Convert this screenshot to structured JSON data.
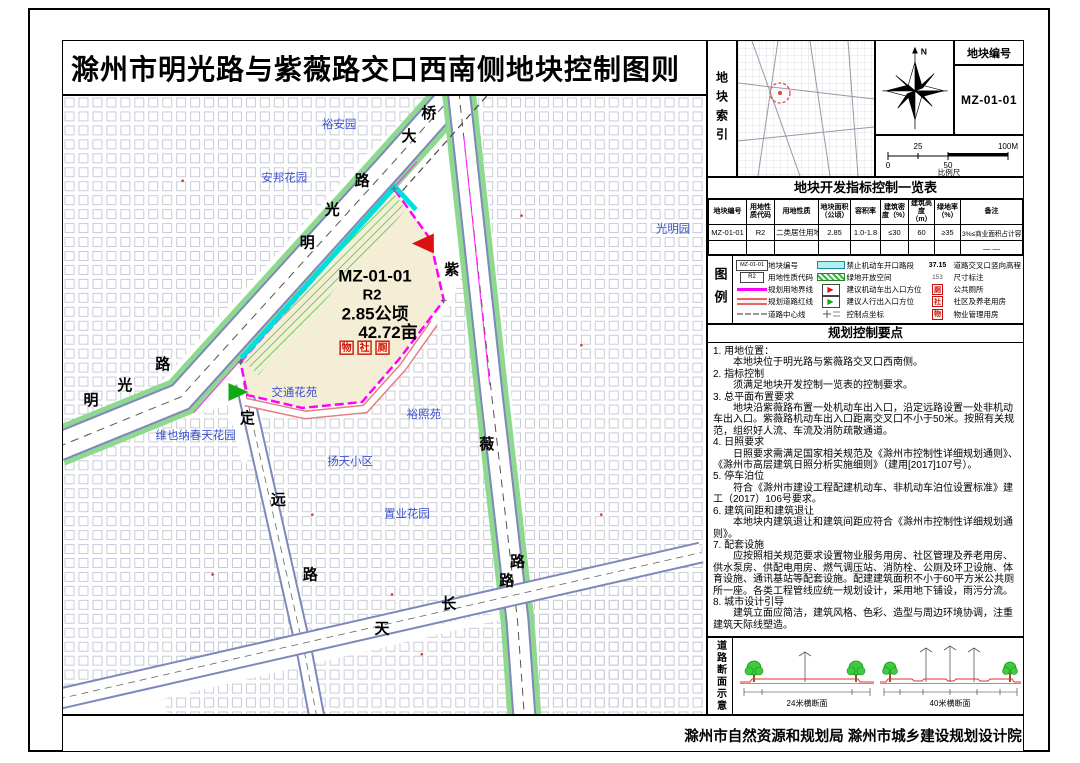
{
  "title": "滁州市明光路与紫薇路交口西南侧地块控制图则",
  "panel": {
    "index_label": "地块索引",
    "parcel_no_label": "地块编号",
    "parcel_no": "MZ-01-01",
    "north_label": "N",
    "scale": {
      "t25": "25",
      "t100": "100M",
      "t0": "0",
      "t50": "50",
      "caption": "比例尺"
    }
  },
  "table": {
    "title": "地块开发指标控制一览表",
    "headers": [
      "地块编号",
      "用地性质代码",
      "用地性质",
      "地块面积（公顷）",
      "容积率",
      "建筑密度（%）",
      "建筑高度（m）",
      "绿地率（%）",
      "备注"
    ],
    "rows": [
      [
        "MZ-01-01",
        "R2",
        "二类居住用地",
        "2.85",
        "1.0-1.8",
        "≤30",
        "60",
        "≥35",
        "3%≤商业面积占计容面积≤10%"
      ],
      [
        "",
        "",
        "",
        "",
        "",
        "",
        "",
        "",
        "— —"
      ]
    ]
  },
  "legend": {
    "label": "图例",
    "swatch1_text": "MZ-01-01",
    "swatch2_text": "R2",
    "col1": [
      {
        "label": "地块编号"
      },
      {
        "label": "用地性质代码"
      },
      {
        "label": "规划用地界线"
      },
      {
        "label": "规划道路红线"
      },
      {
        "label": "道路中心线"
      }
    ],
    "col2": [
      {
        "label": "禁止机动车开口路段"
      },
      {
        "label": "绿地开放空间"
      },
      {
        "label": "建议机动车出入口方位"
      },
      {
        "label": "建议人行出入口方位"
      },
      {
        "label": "控制点坐标"
      }
    ],
    "col3": [
      {
        "value": "37.15",
        "label": "道路交叉口竖向高程"
      },
      {
        "value": "153",
        "label": "尺寸标注"
      },
      {
        "value": "厕",
        "label": "公共厕所"
      },
      {
        "value": "社",
        "label": "社区及养老用房"
      },
      {
        "value": "物",
        "label": "物业管理用房"
      }
    ]
  },
  "notes": {
    "title": "规划控制要点",
    "items": [
      {
        "h": "1. 用地位置：",
        "b": "本地块位于明光路与紫薇路交叉口西南侧。"
      },
      {
        "h": "2. 指标控制",
        "b": "须满足地块开发控制一览表的控制要求。"
      },
      {
        "h": "3. 总平面布置要求",
        "b": "地块沿紫薇路布置一处机动车出入口，沿定远路设置一处非机动车出入口。紫薇路机动车出入口距离交叉口不小于50米。按照有关规范，组织好人流、车流及消防疏散通道。"
      },
      {
        "h": "4. 日照要求",
        "b": "日照要求需满足国家相关规范及《滁州市控制性详细规划通则》、《滁州市高层建筑日照分析实施细则》（建用[2017]107号）。"
      },
      {
        "h": "5. 停车泊位",
        "b": "符合《滁州市建设工程配建机动车、非机动车泊位设置标准》建工（2017）106号要求。"
      },
      {
        "h": "6. 建筑间距和建筑退让",
        "b": "本地块内建筑退让和建筑间距应符合《滁州市控制性详细规划通则》。"
      },
      {
        "h": "7. 配套设施",
        "b": "应按照相关规范要求设置物业服务用房、社区管理及养老用房、供水泵房、供配电用房、燃气调压站、消防栓、公厕及环卫设施、体育设施、通讯基站等配套设施。配建建筑面积不小于60平方米公共厕所一座。各类工程管线应统一规划设计，采用地下铺设，雨污分流。"
      },
      {
        "h": "8. 城市设计引导",
        "b": "建筑立面应简洁，建筑风格、色彩、造型与周边环境协调，注重建筑天际线塑造。"
      }
    ]
  },
  "sections": {
    "label": "道路断面示意",
    "left_caption": "24米横断面",
    "right_caption": "40米横断面"
  },
  "footer": "滁州市自然资源和规划局  滁州市城乡建设规划设计院",
  "map": {
    "parcel": {
      "id": "MZ-01-01",
      "use": "R2",
      "area_ha": "2.85公顷",
      "area_mu": "42.72亩",
      "facilities": [
        "物",
        "社",
        "厕"
      ]
    },
    "roads": {
      "mingguang": [
        "明",
        "光",
        "路",
        "大",
        "桥"
      ],
      "mingguang_w": [
        "明",
        "光",
        "路"
      ],
      "ziwei": [
        "紫",
        "薇",
        "路"
      ],
      "dingyuan": [
        "定",
        "远",
        "路"
      ],
      "tianchang": [
        "天",
        "长",
        "路"
      ]
    },
    "places": [
      "裕安园",
      "安邦花园",
      "光明园",
      "交通花苑",
      "维也纳春天花园",
      "裕照苑",
      "扬天小区",
      "置业花园"
    ]
  },
  "colors": {
    "parcel_boundary": "#ff00ff",
    "no_open_segment": "#00dede",
    "green_space": "#39b54a",
    "road_verge": "#8fd88f",
    "place_label": "#3a4fd0",
    "facility_red": "#cc1111",
    "parcel_fill": "#f5eed6"
  }
}
